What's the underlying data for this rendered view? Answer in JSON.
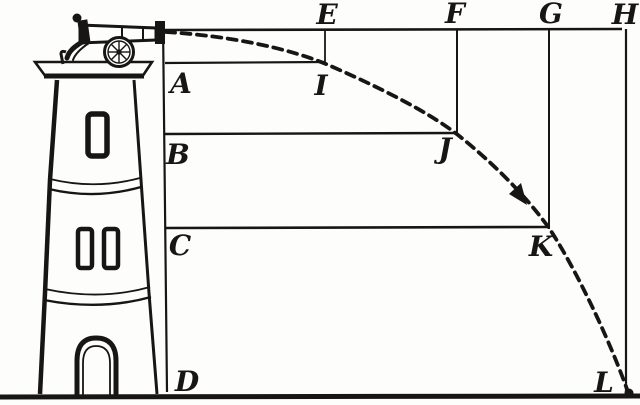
{
  "diagram": {
    "kind": "projectile-motion-engraving",
    "colors": {
      "ink": "#181614",
      "paper": "#fdfdfb"
    }
  },
  "points": {
    "E": "E",
    "F": "F",
    "G": "G",
    "H": "H",
    "A": "A",
    "I": "I",
    "B": "B",
    "J": "J",
    "C": "C",
    "K": "K",
    "D": "D",
    "L": "L"
  }
}
